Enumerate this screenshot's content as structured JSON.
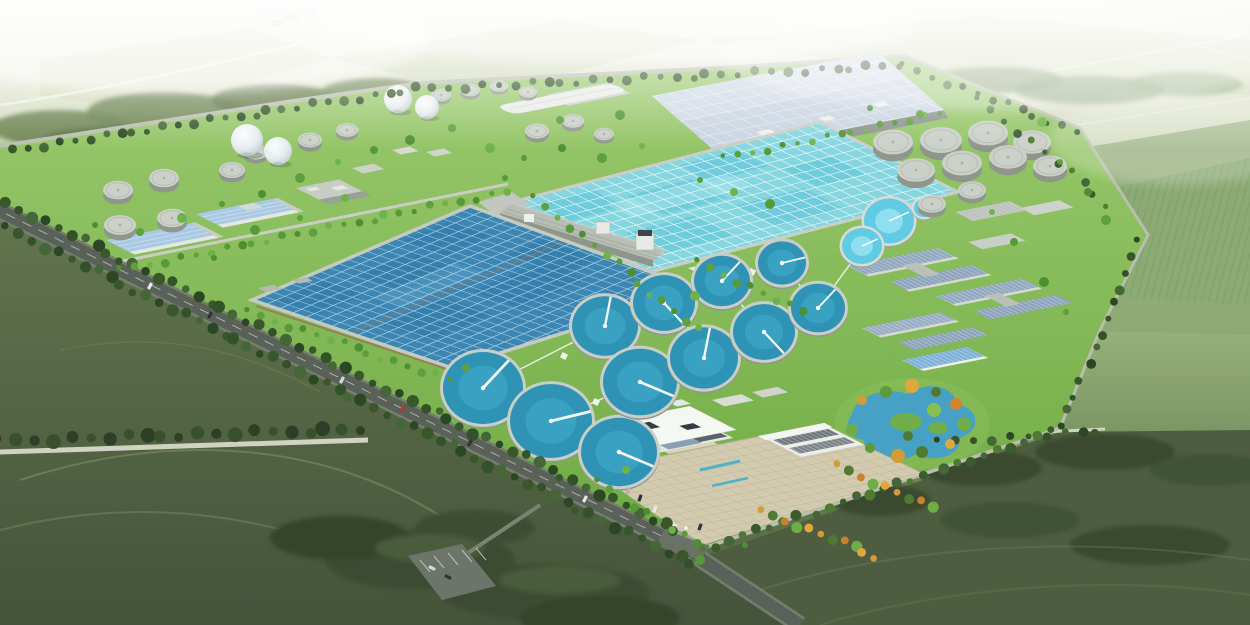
{
  "meta": {
    "type": "3d-aerial-architectural-rendering",
    "subject": "large wastewater treatment plant campus set in green farmland",
    "view": "elevated oblique bird's-eye view, rectangular campus rotated diagonally, hazy horizon at top",
    "visible_text": "none"
  },
  "palette": {
    "haze": "#eef0e1",
    "far_field": "#c9d4ae",
    "mid_field": "#93ad77",
    "dark_field": "#4e5d40",
    "lawn": "#7fba50",
    "lawn_light": "#98c96b",
    "boulevard": "#5a6158",
    "walkway": "#f0f4ef",
    "basin_deep": "#3c86b4",
    "basin_light": "#86d6e0",
    "clarifier": "#2f93b6",
    "thickener": "#62cbe4",
    "tank_top": "#cbd1c9",
    "tank_side": "#8f978c",
    "sphere": "#eef2f2",
    "roof_blue": "#a9c9e4",
    "roof_slate": "#92a8c0",
    "roof_glass": "#c9d3e0",
    "building_white": "#f2f4f0",
    "plaza": "#d3cbb0",
    "pond": "#3f9fd0",
    "tree_dark": "#2f4a27",
    "tree_bright": "#5ea03d",
    "tree_autumn": "#d49a36"
  },
  "scene": {
    "facilities": [
      "oxidation-ditch-basin-southwest",
      "aeration-basin-north",
      "covered-panel-roof-hall",
      "secondary-clarifier-field",
      "sludge-digester-tanks",
      "gas-holder-spheres",
      "covered-storage-tanks-northeast",
      "workshop-building-complexes",
      "administration-building",
      "entrance-plaza",
      "landscape-pond-garden",
      "tree-lined-perimeter-boulevard",
      "surrounding-farmland"
    ],
    "spheres": [
      [
        247,
        140,
        16
      ],
      [
        278,
        151,
        14
      ],
      [
        398,
        99,
        14
      ],
      [
        427,
        107,
        12
      ]
    ],
    "gray_tanks": [
      [
        118,
        190,
        15
      ],
      [
        164,
        178,
        15
      ],
      [
        120,
        225,
        16
      ],
      [
        172,
        218,
        15
      ],
      [
        232,
        170,
        13
      ],
      [
        256,
        152,
        12
      ],
      [
        310,
        140,
        12
      ],
      [
        347,
        130,
        11
      ],
      [
        441,
        95,
        10
      ],
      [
        470,
        90,
        10
      ],
      [
        499,
        86,
        9
      ],
      [
        528,
        92,
        9
      ],
      [
        537,
        131,
        12
      ],
      [
        573,
        121,
        11
      ],
      [
        604,
        134,
        10
      ],
      [
        893,
        142,
        20
      ],
      [
        941,
        140,
        21
      ],
      [
        988,
        133,
        20
      ],
      [
        1032,
        142,
        19
      ],
      [
        916,
        170,
        19
      ],
      [
        962,
        163,
        20
      ],
      [
        1008,
        157,
        19
      ],
      [
        1050,
        166,
        17
      ],
      [
        932,
        204,
        14
      ],
      [
        972,
        190,
        14
      ]
    ],
    "thickeners": [
      [
        889,
        221,
        25
      ],
      [
        862,
        246,
        20
      ],
      [
        924,
        208,
        10
      ]
    ],
    "clarifiers": [
      [
        483,
        388,
        40
      ],
      [
        551,
        421,
        41
      ],
      [
        619,
        452,
        38
      ],
      [
        605,
        326,
        33
      ],
      [
        664,
        303,
        31
      ],
      [
        722,
        281,
        28
      ],
      [
        782,
        263,
        24
      ],
      [
        640,
        382,
        37
      ],
      [
        704,
        358,
        34
      ],
      [
        764,
        332,
        31
      ],
      [
        818,
        308,
        27
      ]
    ],
    "walkways": [
      [
        [
          605,
          326
        ],
        [
          664,
          303
        ],
        [
          722,
          281
        ],
        [
          782,
          263
        ]
      ],
      [
        [
          640,
          382
        ],
        [
          704,
          358
        ],
        [
          764,
          332
        ],
        [
          818,
          308
        ]
      ],
      [
        [
          483,
          388
        ],
        [
          551,
          421
        ],
        [
          619,
          452
        ]
      ],
      [
        [
          605,
          326
        ],
        [
          640,
          382
        ]
      ],
      [
        [
          664,
          303
        ],
        [
          704,
          358
        ]
      ],
      [
        [
          722,
          281
        ],
        [
          764,
          332
        ]
      ],
      [
        [
          782,
          263
        ],
        [
          818,
          308
        ]
      ],
      [
        [
          483,
          388
        ],
        [
          605,
          326
        ]
      ],
      [
        [
          551,
          421
        ],
        [
          640,
          382
        ]
      ],
      [
        [
          818,
          308
        ],
        [
          862,
          248
        ]
      ]
    ],
    "walkway_pads": [
      [
        634,
        314
      ],
      [
        693,
        292
      ],
      [
        752,
        272
      ],
      [
        672,
        370
      ],
      [
        734,
        345
      ],
      [
        791,
        320
      ],
      [
        564,
        356
      ],
      [
        596,
        402
      ]
    ],
    "tree_rows": [
      [
        0,
        152,
        418,
        89,
        15,
        4,
        "dark"
      ],
      [
        418,
        89,
        900,
        66,
        16,
        4,
        "dark"
      ],
      [
        905,
        66,
        1078,
        132,
        15,
        3.5,
        "dark"
      ],
      [
        1140,
        242,
        1062,
        426,
        16,
        4,
        "dark"
      ],
      [
        1054,
        432,
        700,
        550,
        15,
        4.5,
        "mixed"
      ],
      [
        -5,
        197,
        676,
        531,
        14,
        5,
        "dark"
      ],
      [
        8,
        228,
        692,
        564,
        14,
        5,
        "dark"
      ],
      [
        0,
        441,
        362,
        429,
        18,
        6,
        "darkest"
      ],
      [
        250,
        312,
        448,
        380,
        14,
        3.5,
        "bright"
      ],
      [
        536,
        198,
        698,
        330,
        15,
        3.5,
        "bright"
      ],
      [
        122,
        270,
        504,
        192,
        15,
        3.5,
        "bright"
      ],
      [
        700,
        262,
        800,
        312,
        14,
        3.5,
        "bright"
      ],
      [
        980,
        100,
        1108,
        204,
        17,
        3.5,
        "mixed"
      ],
      [
        840,
        466,
        930,
        508,
        12,
        4.5,
        "autumn"
      ],
      [
        764,
        512,
        876,
        556,
        12,
        4.5,
        "autumn"
      ],
      [
        600,
        482,
        694,
        544,
        14,
        3.5,
        "bright"
      ],
      [
        940,
        442,
        1098,
        432,
        18,
        4,
        "dark"
      ],
      [
        726,
        158,
        938,
        114,
        14,
        3,
        "bright"
      ]
    ],
    "tree_singles": [
      [
        95,
        225
      ],
      [
        140,
        232
      ],
      [
        182,
        218
      ],
      [
        222,
        204
      ],
      [
        262,
        194
      ],
      [
        300,
        178
      ],
      [
        338,
        162
      ],
      [
        374,
        150
      ],
      [
        410,
        140
      ],
      [
        300,
        218
      ],
      [
        345,
        198
      ],
      [
        255,
        230
      ],
      [
        214,
        258
      ],
      [
        452,
        128
      ],
      [
        490,
        148
      ],
      [
        524,
        158
      ],
      [
        562,
        148
      ],
      [
        602,
        158
      ],
      [
        642,
        146
      ],
      [
        560,
        120
      ],
      [
        620,
        115
      ],
      [
        700,
        180
      ],
      [
        734,
        192
      ],
      [
        770,
        204
      ],
      [
        870,
        108
      ],
      [
        920,
        114
      ],
      [
        1042,
        122
      ],
      [
        1060,
        162
      ],
      [
        1088,
        192
      ],
      [
        1106,
        220
      ],
      [
        992,
        212
      ],
      [
        1014,
        242
      ],
      [
        1044,
        282
      ],
      [
        1066,
        312
      ],
      [
        626,
        470
      ],
      [
        700,
        560
      ],
      [
        745,
        545
      ],
      [
        466,
        368
      ],
      [
        695,
        296
      ],
      [
        505,
        178
      ]
    ],
    "garden_trees": [
      [
        862,
        400,
        "#d49a36"
      ],
      [
        886,
        392,
        "#5e9a3a"
      ],
      [
        912,
        386,
        "#e0a83c"
      ],
      [
        936,
        392,
        "#4f7a34"
      ],
      [
        956,
        404,
        "#d4842f"
      ],
      [
        964,
        424,
        "#6fae47"
      ],
      [
        950,
        444,
        "#e0a83c"
      ],
      [
        922,
        452,
        "#4f7a34"
      ],
      [
        898,
        456,
        "#d49a36"
      ],
      [
        870,
        448,
        "#5e9a3a"
      ],
      [
        852,
        430,
        "#6fae47"
      ],
      [
        934,
        410,
        "#87c04f"
      ],
      [
        908,
        436,
        "#4f7a34"
      ]
    ],
    "vehicles": [
      [
        150,
        286,
        "#e8eae8",
        27
      ],
      [
        210,
        315,
        "#2e3338",
        27
      ],
      [
        342,
        380,
        "#d8d8d8",
        27
      ],
      [
        402,
        409,
        "#b53a30",
        27
      ],
      [
        470,
        443,
        "#30353b",
        27
      ],
      [
        585,
        499,
        "#e8eae8",
        27
      ],
      [
        640,
        498,
        "#2e3338",
        20
      ],
      [
        655,
        509,
        "#e6e8e6",
        20
      ],
      [
        628,
        491,
        "#b0b4b8",
        20
      ],
      [
        700,
        527,
        "#30353b",
        20
      ],
      [
        432,
        568,
        "#d8d8d8",
        115
      ],
      [
        448,
        577,
        "#2e3338",
        115
      ]
    ]
  }
}
